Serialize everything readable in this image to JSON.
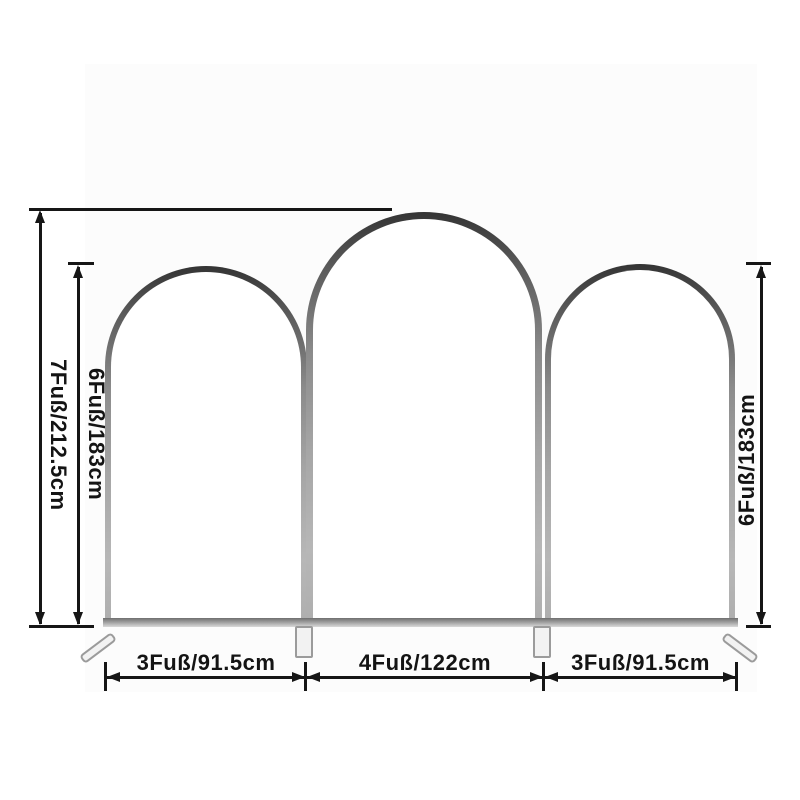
{
  "page": {
    "type": "product-dimension-diagram",
    "subject": "three-piece arched backdrop stand set",
    "background": "#ffffff"
  },
  "colors": {
    "dimension_line": "#161616",
    "frame_metal_dark": "#343434",
    "frame_metal_light": "#b7b7b7",
    "foot_fill": "#f2f2f2",
    "foot_border": "#9b9b9b"
  },
  "arches": [
    {
      "position": "left",
      "height_label": "6Fuß/183cm",
      "width_label": "3Fuß/91.5cm"
    },
    {
      "position": "middle",
      "height_label": "7Fuß/212.5cm",
      "width_label": "4Fuß/122cm"
    },
    {
      "position": "right",
      "height_label": "6Fuß/183cm",
      "width_label": "3Fuß/91.5cm"
    }
  ],
  "dimension_labels": {
    "overall_height": "7Fuß/212.5cm",
    "left_height": "6Fuß/183cm",
    "right_height": "6Fuß/183cm",
    "width_left": "3Fuß/91.5cm",
    "width_middle": "4Fuß/122cm",
    "width_right": "3Fuß/91.5cm"
  }
}
